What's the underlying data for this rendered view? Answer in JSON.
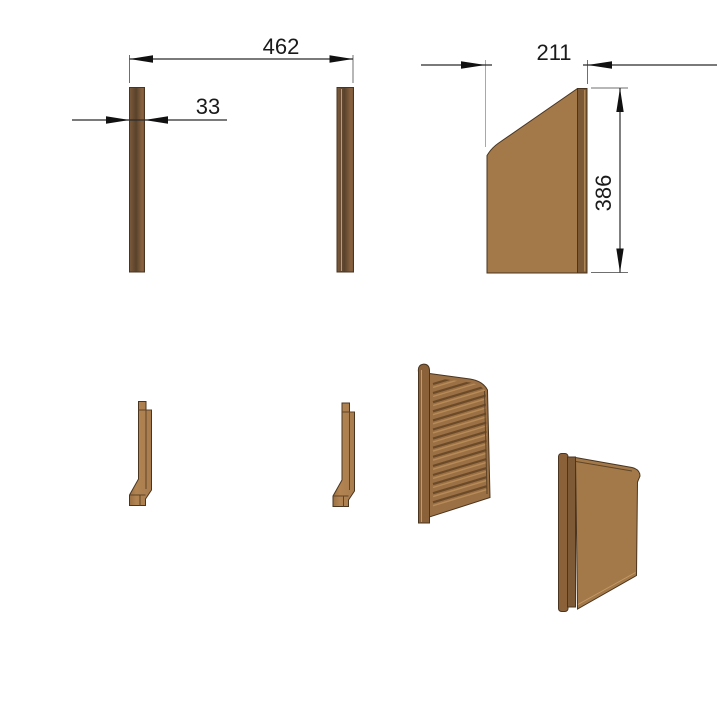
{
  "dimensions": {
    "overall_width": "462",
    "bar_thickness": "33",
    "top_width": "211",
    "panel_height": "386"
  },
  "louvered_panel": {
    "louver_count": 14
  },
  "colors": {
    "background": "#ffffff",
    "face": "#a3794a",
    "face_light": "#b28452",
    "face_mid": "#9b7044",
    "edge_dark": "#7b5936",
    "strip": "#8a6138",
    "strip_inner": "#7e5a36",
    "outline": "#4a3520",
    "dim_line": "#2b2b2b",
    "text": "#1a1a1a",
    "louver_groove": "#6b4a2a",
    "louver_highlight": "#b78b58"
  }
}
